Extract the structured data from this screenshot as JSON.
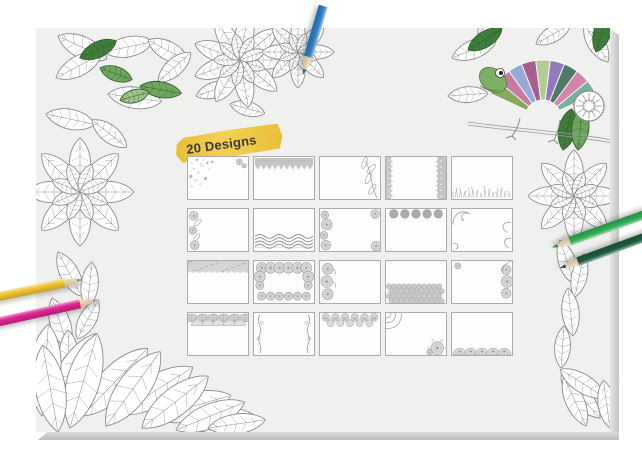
{
  "badge": {
    "label": "20 Designs",
    "text_color": "#3a3a3a",
    "highlight_color": "#e9bb2e",
    "highlight_color_light": "#f3cf4e"
  },
  "pad": {
    "face_color": "#f0f0ee",
    "surround_color": "#ffffff",
    "edge_color": "#c6c6c4"
  },
  "grid": {
    "rows": 4,
    "cols": 5,
    "count": 20,
    "card_fill": "#fdfdfd",
    "card_border": "#ababab",
    "ornament_color": "#9a9a9a",
    "ornament_fill": "#c5c5c5",
    "cards": [
      {
        "id": 1,
        "design": "corner-floral-sprays",
        "description": "light floral speckles in top-left corner and small top-right cluster"
      },
      {
        "id": 2,
        "design": "zigzag-top-band",
        "description": "solid gray patterned band across the top with zigzag lower edge"
      },
      {
        "id": 3,
        "design": "right-leaf-vine",
        "description": "leafy vine climbing the right edge"
      },
      {
        "id": 4,
        "design": "side-paisley-borders",
        "description": "ornate paisley borders on left and right edges"
      },
      {
        "id": 5,
        "design": "bottom-meadow-band",
        "description": "grassy meadow doodle band along the bottom"
      },
      {
        "id": 6,
        "design": "left-floral-border",
        "description": "flowers and leaves along the left edge"
      },
      {
        "id": 7,
        "design": "bottom-braid-band",
        "description": "woven braid band near the bottom"
      },
      {
        "id": 8,
        "design": "left-mandala-border",
        "description": "mandala flowers down the left edge with corner medallions on right"
      },
      {
        "id": 9,
        "design": "top-dot-row",
        "description": "row of five solid circles along the top"
      },
      {
        "id": 10,
        "design": "corner-swirl-borders",
        "description": "swirl curls in top-left corner and along the right edge"
      },
      {
        "id": 11,
        "design": "top-texture-band",
        "description": "mottled texture band across the top"
      },
      {
        "id": 12,
        "design": "full-floral-wreath",
        "description": "dense floral wreath framing the whole card"
      },
      {
        "id": 13,
        "design": "left-three-medallions",
        "description": "three paisley medallions stacked on the left"
      },
      {
        "id": 14,
        "design": "bottom-flower-field",
        "description": "field of small flowers across the lower half"
      },
      {
        "id": 15,
        "design": "right-medallion-border",
        "description": "medallion column on the right edge with small top-left bloom"
      },
      {
        "id": 16,
        "design": "top-fan-band",
        "description": "overlapping scalloped fans along the top"
      },
      {
        "id": 17,
        "design": "side-vine-borders",
        "description": "curling vines on left and right edges"
      },
      {
        "id": 18,
        "design": "top-rose-band",
        "description": "band of spiral roses across the top"
      },
      {
        "id": 19,
        "design": "diagonal-corner-mandalas",
        "description": "arc ornament top-left and mandala cluster bottom-right"
      },
      {
        "id": 20,
        "design": "bottom-sun-scallops",
        "description": "row of half-sun scallop medallions along the bottom"
      }
    ]
  },
  "pencils": [
    {
      "id": "blue",
      "color": "#2e7fc2",
      "tip": "#2361a0"
    },
    {
      "id": "yellow",
      "color": "#f0c42e",
      "tip": "#8d8d8d"
    },
    {
      "id": "magenta",
      "color": "#dd2391",
      "tip": "#e07fb4"
    },
    {
      "id": "light-green",
      "color": "#2fae54",
      "tip": "#1d8a3e"
    },
    {
      "id": "dark-green",
      "color": "#1d5c41",
      "tip": "#134531"
    }
  ],
  "artwork": {
    "line_color": "#8b8b8b",
    "leaf_greens": [
      "#3f7d3a",
      "#6fa75f",
      "#9cc489"
    ],
    "chameleon": {
      "body_colors": [
        "#86a861",
        "#c77ba2",
        "#97a8d9",
        "#a95f8b",
        "#b3cc93",
        "#9579bd",
        "#4e7a68",
        "#d584ab",
        "#74b29c"
      ],
      "head_color": "#7fae66",
      "eye_color": "#ffffff",
      "pupil_color": "#222222"
    }
  }
}
